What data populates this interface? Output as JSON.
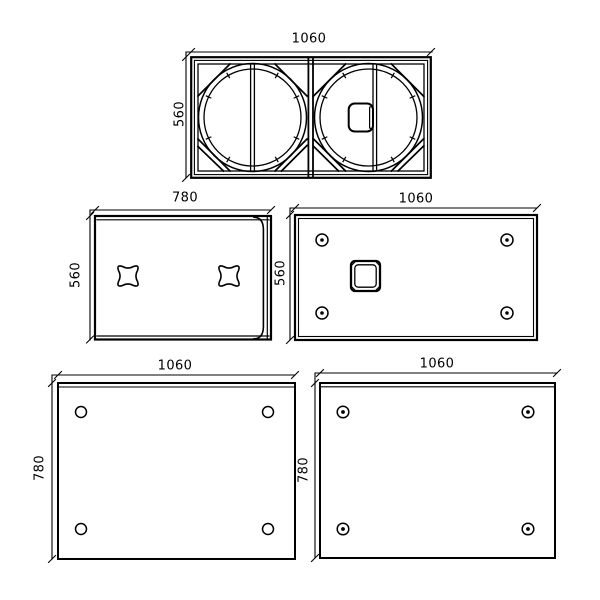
{
  "drawing": {
    "background_color": "#ffffff",
    "line_color": "#000000",
    "views": {
      "front": {
        "width_label": "1060",
        "height_label": "560"
      },
      "side": {
        "width_label": "780",
        "height_label": "560"
      },
      "rear": {
        "width_label": "1060",
        "height_label": "560"
      },
      "top": {
        "width_label": "1060",
        "height_label": "780"
      },
      "bottom": {
        "width_label": "1060",
        "height_label": "780"
      }
    }
  }
}
